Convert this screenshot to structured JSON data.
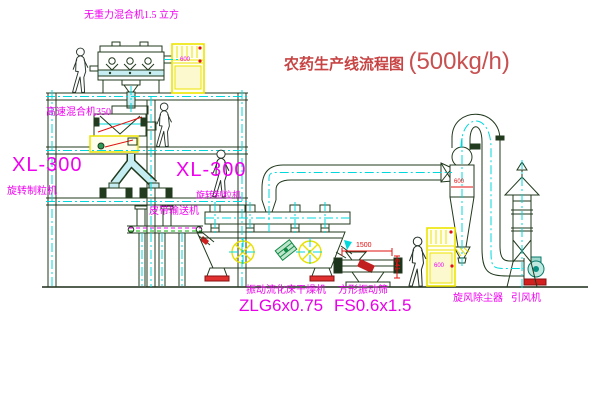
{
  "title": {
    "name": "农药生产线流程图",
    "capacity": "(500kg/h)"
  },
  "labels": {
    "zero_gravity_mixer": "无重力混合机1.5 立方",
    "high_speed_mixer": "高速混合机350",
    "granulator_left_model": "XL-300",
    "granulator_left_name": "旋转制粒机",
    "granulator_right_model": "XL-300",
    "granulator_right_name": "旋转制粒机",
    "belt_conveyor": "皮带输送机",
    "dryer_name": "振动流化床干燥机",
    "dryer_model": "ZLG6x0.75",
    "screen_name": "方形振动筛",
    "screen_model": "FS0.6x1.5",
    "cyclone": "旋风除尘器",
    "fan": "引风机"
  },
  "dimensions": {
    "screen_length": "1500",
    "screen_height": "541",
    "cyclone_body": "600"
  },
  "cabinets": {
    "top_panel_text": "600",
    "bottom_panel_text": "600"
  },
  "colors": {
    "line": "#223a1e",
    "centerline": "#00d8dc",
    "label_magenta": "#f000f0",
    "title_red": "#c84444",
    "dimension_red": "#e01010",
    "cabinet_yellow": "#ece400",
    "chute_cyan_fill": "#c6eef2",
    "motor_green": "#1f9e53",
    "fan_teal": "#0a8f83"
  }
}
